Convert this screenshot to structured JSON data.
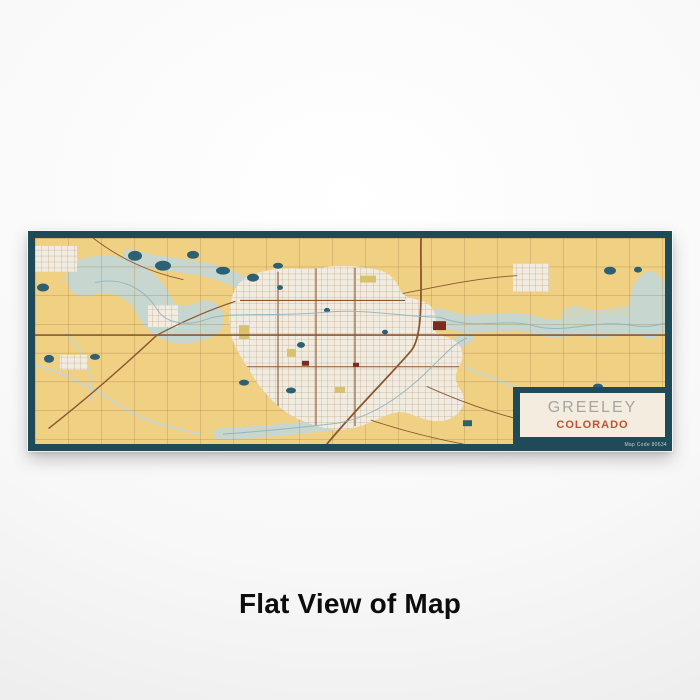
{
  "caption": "Flat View of Map",
  "map_label": {
    "city": "GREELEY",
    "state": "COLORADO",
    "map_code": "Map Code 80634"
  },
  "map": {
    "style": "woodblock",
    "features": [
      "rural-section-road-grid",
      "city-street-grid",
      "river-corridors",
      "wetlands",
      "ponds",
      "landmark-blocks"
    ],
    "region": "Greeley, Colorado area"
  },
  "colors": {
    "frame_teal": "#1F4A57",
    "land_yellow": "#F0D083",
    "water_light": "#C7D6CE",
    "pond_dark": "#2E6074",
    "road_brown": "#A9814C",
    "road_major": "#8A5731",
    "city_cream": "#F1ECE1",
    "label_cream": "#F3ECDF",
    "landmark_red": "#7C2B1F",
    "city_text_gray": "#A5A5A3",
    "state_orange": "#C2512F",
    "caption_black": "#0D0D0D"
  }
}
